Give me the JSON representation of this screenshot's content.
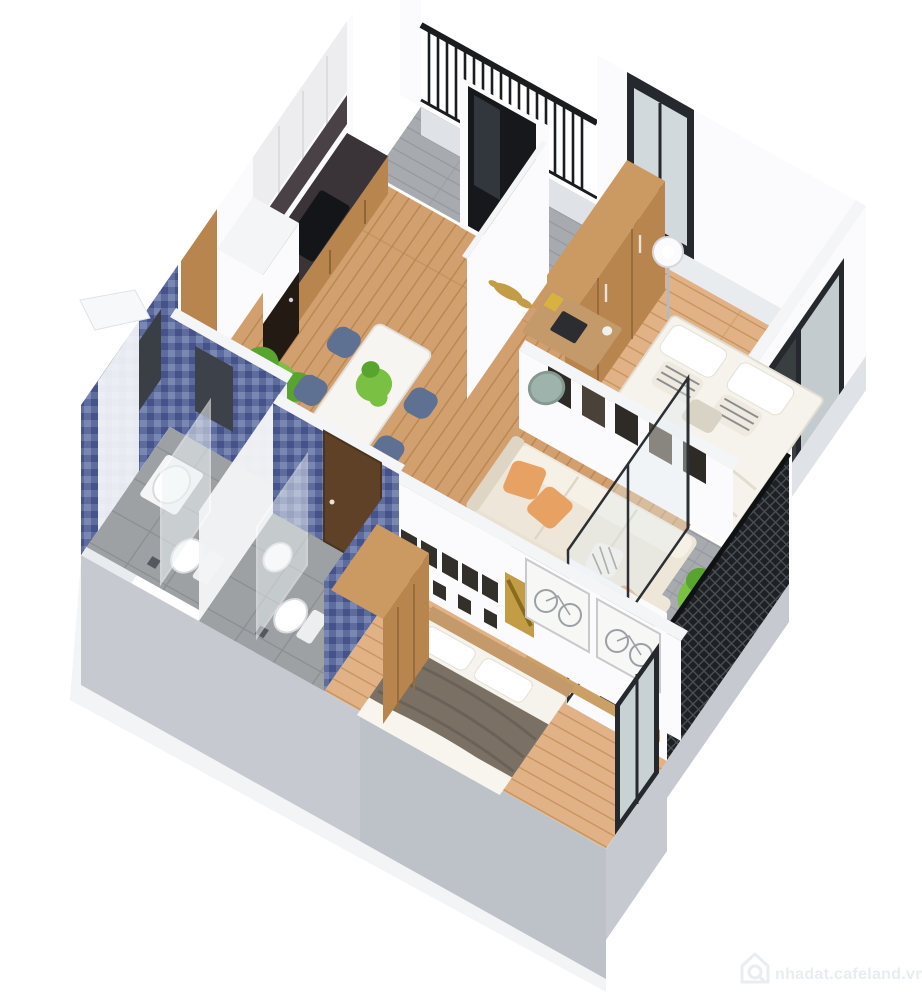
{
  "image": {
    "kind": "3d-isometric-floorplan-render",
    "description": "Cutaway axonometric render of a two-bedroom apartment with two bathrooms, two balconies, open kitchen-dining-living area"
  },
  "watermark": {
    "text": "nhadat.cafeland.vn",
    "icon": "house-search"
  },
  "palette": {
    "wall_top": "#f4f5f7",
    "wall_face": "#fbfbfd",
    "wall_shade": "#ededf0",
    "outer_gray": "#c6cad0",
    "outer_gray2": "#b6bac1",
    "slab": "#dfe2e6",
    "slab_light": "#e9ecef",
    "wood_floor": "#d2a06f",
    "wood_floor_seam": "#b9854e",
    "wood_floor_b": "#e1b286",
    "wood_floor_b_seam": "#c5945f",
    "gray_plank": "#a7aaae",
    "gray_plank_seam": "#94979b",
    "tile": "#9da1a4",
    "tile_seam": "#8b8f92",
    "mosaic_a": "#5d6b9d",
    "mosaic_b": "#7a87b3",
    "mosaic_c": "#46538a",
    "rug": "#e9e2d3",
    "rug_line": "#d8cebc",
    "sofa": "#eee7d9",
    "sofa_light": "#f6f1e6",
    "sofa_shade": "#ded5c4",
    "pillow_orange": "#e7a263",
    "walnut": "#64452b",
    "wood_cab": "#b9854f",
    "wood_cab_light": "#cb9a62",
    "headboard": "#c49a6a",
    "marble_dark": "#3a3337",
    "appliance_black": "#17181b",
    "frame_black": "#25282c",
    "glass": "#dfe8ec",
    "glass_dark": "#3c4044",
    "plant": "#79c043",
    "plant_dark": "#57a52f",
    "bed_white": "#f6f3ec",
    "bed2_blanket": "#7a7164",
    "bed2_blanket_dark": "#6b6257",
    "chair_blue": "#5e7193",
    "chair_teal": "#9eb3ab",
    "gold": "#c39d46",
    "watermark": "#e9edef"
  },
  "rooms": [
    {
      "id": "top-balcony",
      "features": [
        "black-baluster-railing",
        "gray-plank-floor",
        "dark-glass-door"
      ]
    },
    {
      "id": "kitchen",
      "features": [
        "wood-cabinets",
        "dark-marble-counter",
        "black-cooktop-sink",
        "fridge",
        "tall-white-cabinet",
        "monstera-plant"
      ]
    },
    {
      "id": "dining-area",
      "features": [
        "white-table",
        "4-blue-chairs",
        "table-plant"
      ]
    },
    {
      "id": "desk-nook",
      "features": [
        "white-partition-gold-fish-art",
        "wood-desk",
        "laptop",
        "teal-chair"
      ]
    },
    {
      "id": "bedroom-1",
      "features": [
        "wood-wardrobe",
        "floor-lamp",
        "double-bed-white-duvet",
        "striped-pillows",
        "corner-glazing",
        "window"
      ]
    },
    {
      "id": "living-room",
      "features": [
        "l-shaped-cream-sofa",
        "orange-pillows",
        "checkered-pillows",
        "walnut-coffee-table",
        "geometric-rug",
        "five-picture-frames"
      ]
    },
    {
      "id": "right-balcony",
      "features": [
        "black-lattice-railing",
        "gray-plank-floor",
        "plant",
        "sliding-glass-doors"
      ]
    },
    {
      "id": "bathroom-1",
      "features": [
        "blue-mosaic-walls",
        "mirror",
        "counter-basin",
        "toilet",
        "shower-partition",
        "wood-door"
      ]
    },
    {
      "id": "bathroom-2",
      "features": [
        "blue-mosaic-walls",
        "toilet",
        "glass-shower-screen",
        "walnut-door",
        "mirror"
      ]
    },
    {
      "id": "bedroom-2",
      "features": [
        "wood-wardrobe",
        "bed-dark-gray-blanket",
        "gallery-mini-frames",
        "two-bicycle-prints",
        "gold-artwork",
        "window"
      ]
    }
  ]
}
